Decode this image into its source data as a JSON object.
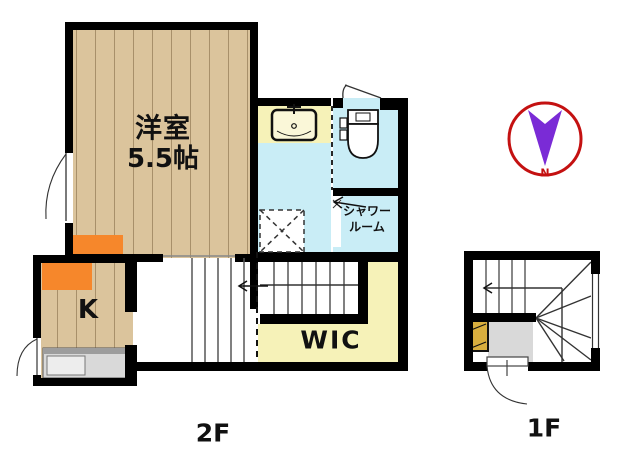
{
  "plan": {
    "floor_2f": {
      "title": "2F",
      "rooms": {
        "western_room": {
          "name": "洋室",
          "size": "5.5帖"
        },
        "kitchen": {
          "name": "K"
        },
        "walk_in_closet": {
          "name": "WIC"
        },
        "shower_room": {
          "name_line1": "シャワー",
          "name_line2": "ルーム"
        }
      }
    },
    "floor_1f": {
      "title": "1F"
    },
    "compass": {
      "north_label": "N"
    }
  },
  "colors": {
    "wall": "#000000",
    "wood_floor": "#DBC49C",
    "wood_plank_line": "#A8906A",
    "accent_orange": "#F6872B",
    "pale_yellow": "#F6F2B8",
    "water_blue": "#C9EDF6",
    "gray_fixture": "#D9D9D9",
    "mustard_cabinet": "#D8AE3E",
    "compass_red": "#C41111",
    "compass_purple": "#7A2BD6"
  }
}
